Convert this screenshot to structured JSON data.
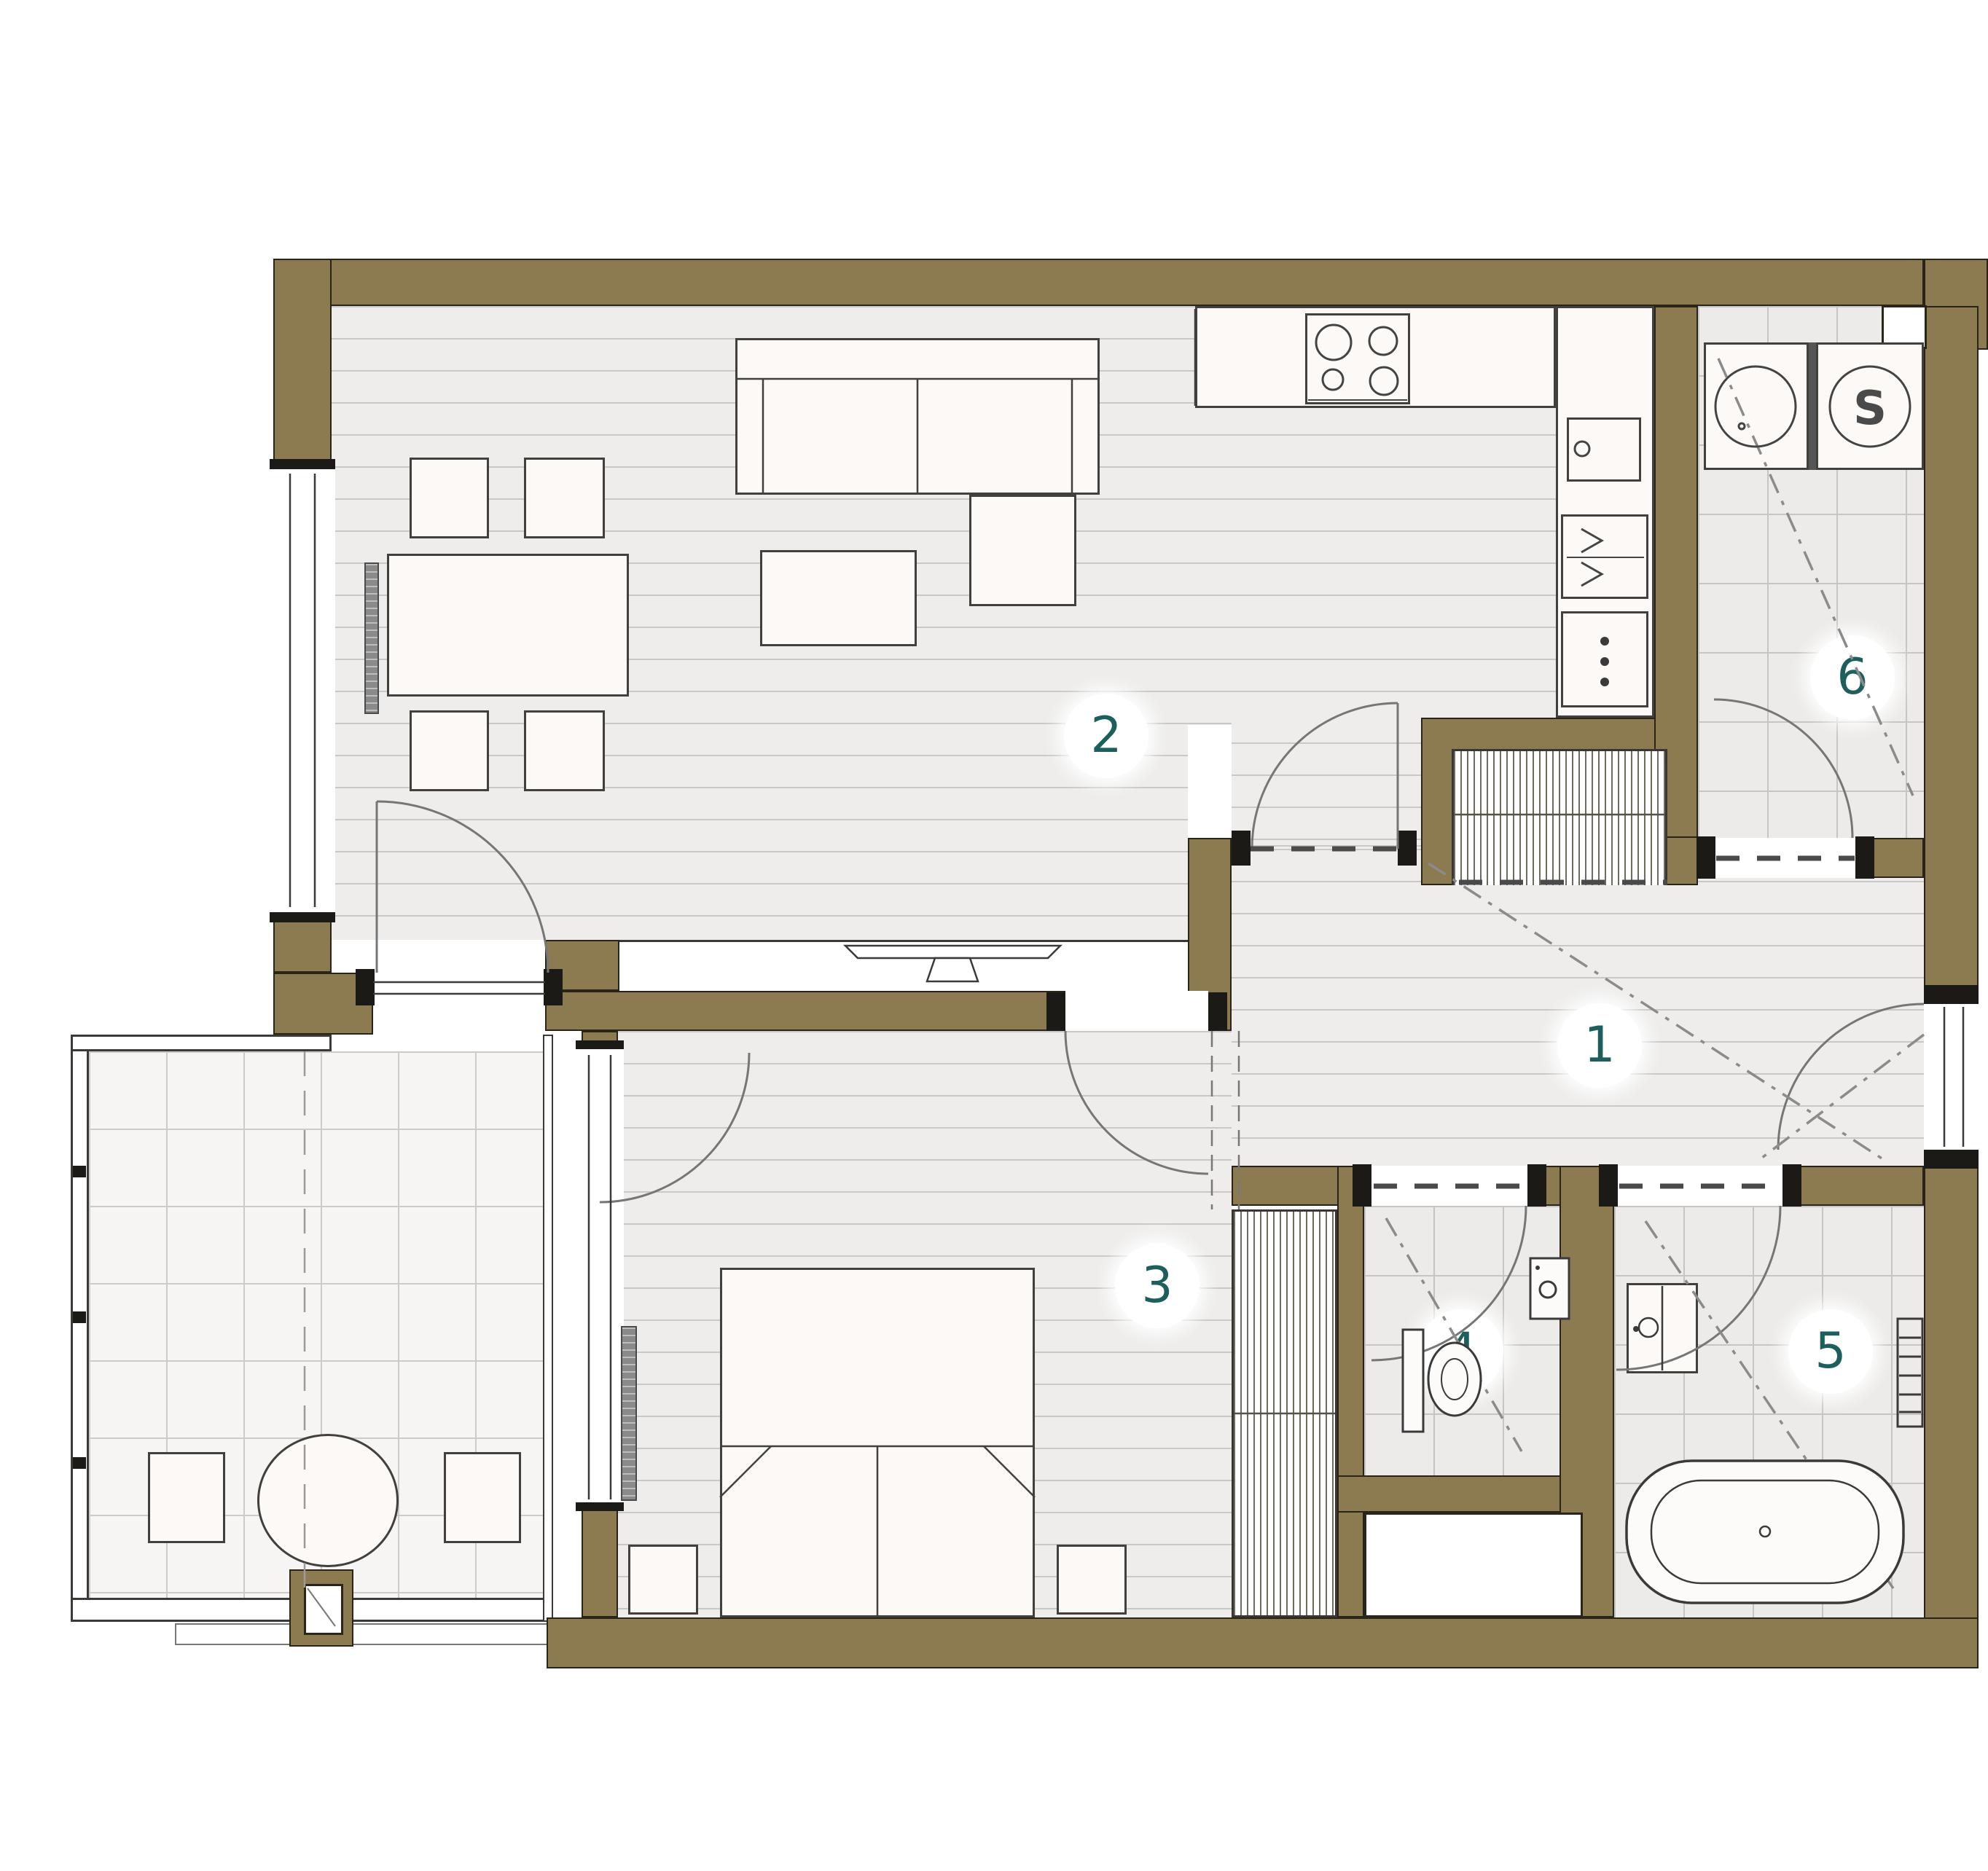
{
  "plan": {
    "rooms": [
      {
        "label": "1"
      },
      {
        "label": "2"
      },
      {
        "label": "3"
      },
      {
        "label": "4"
      },
      {
        "label": "5"
      },
      {
        "label": "6"
      }
    ],
    "dryer_letter": "S",
    "colors": {
      "wall": "#8c7b50",
      "room_label": "#1d5f5c",
      "floor_line": "#c9c8c6",
      "tile_line": "#c6c5c3",
      "furniture_outline": "#42403c"
    }
  }
}
